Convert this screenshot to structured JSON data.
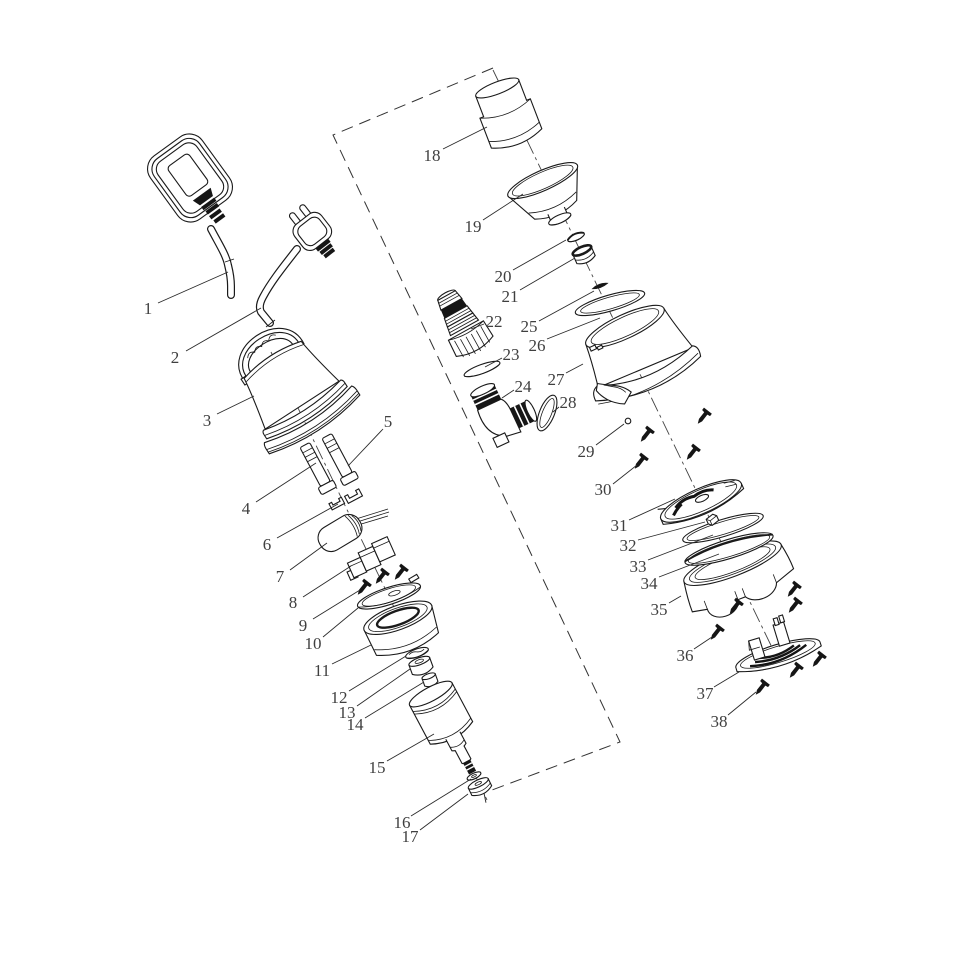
{
  "figure": {
    "type": "exploded-parts-diagram",
    "background_color": "#ffffff",
    "line_color": "#1a1a1a",
    "label_color": "#3f3f3f"
  },
  "callouts": [
    {
      "label": "1"
    },
    {
      "label": "2"
    },
    {
      "label": "3"
    },
    {
      "label": "4"
    },
    {
      "label": "5"
    },
    {
      "label": "6"
    },
    {
      "label": "7"
    },
    {
      "label": "8"
    },
    {
      "label": "9"
    },
    {
      "label": "10"
    },
    {
      "label": "11"
    },
    {
      "label": "12"
    },
    {
      "label": "13"
    },
    {
      "label": "14"
    },
    {
      "label": "15"
    },
    {
      "label": "16"
    },
    {
      "label": "17"
    },
    {
      "label": "18"
    },
    {
      "label": "19"
    },
    {
      "label": "20"
    },
    {
      "label": "21"
    },
    {
      "label": "22"
    },
    {
      "label": "23"
    },
    {
      "label": "24"
    },
    {
      "label": "25"
    },
    {
      "label": "26"
    },
    {
      "label": "27"
    },
    {
      "label": "28"
    },
    {
      "label": "29"
    },
    {
      "label": "30"
    },
    {
      "label": "31"
    },
    {
      "label": "32"
    },
    {
      "label": "33"
    },
    {
      "label": "34"
    },
    {
      "label": "35"
    },
    {
      "label": "36"
    },
    {
      "label": "37"
    },
    {
      "label": "38"
    }
  ]
}
